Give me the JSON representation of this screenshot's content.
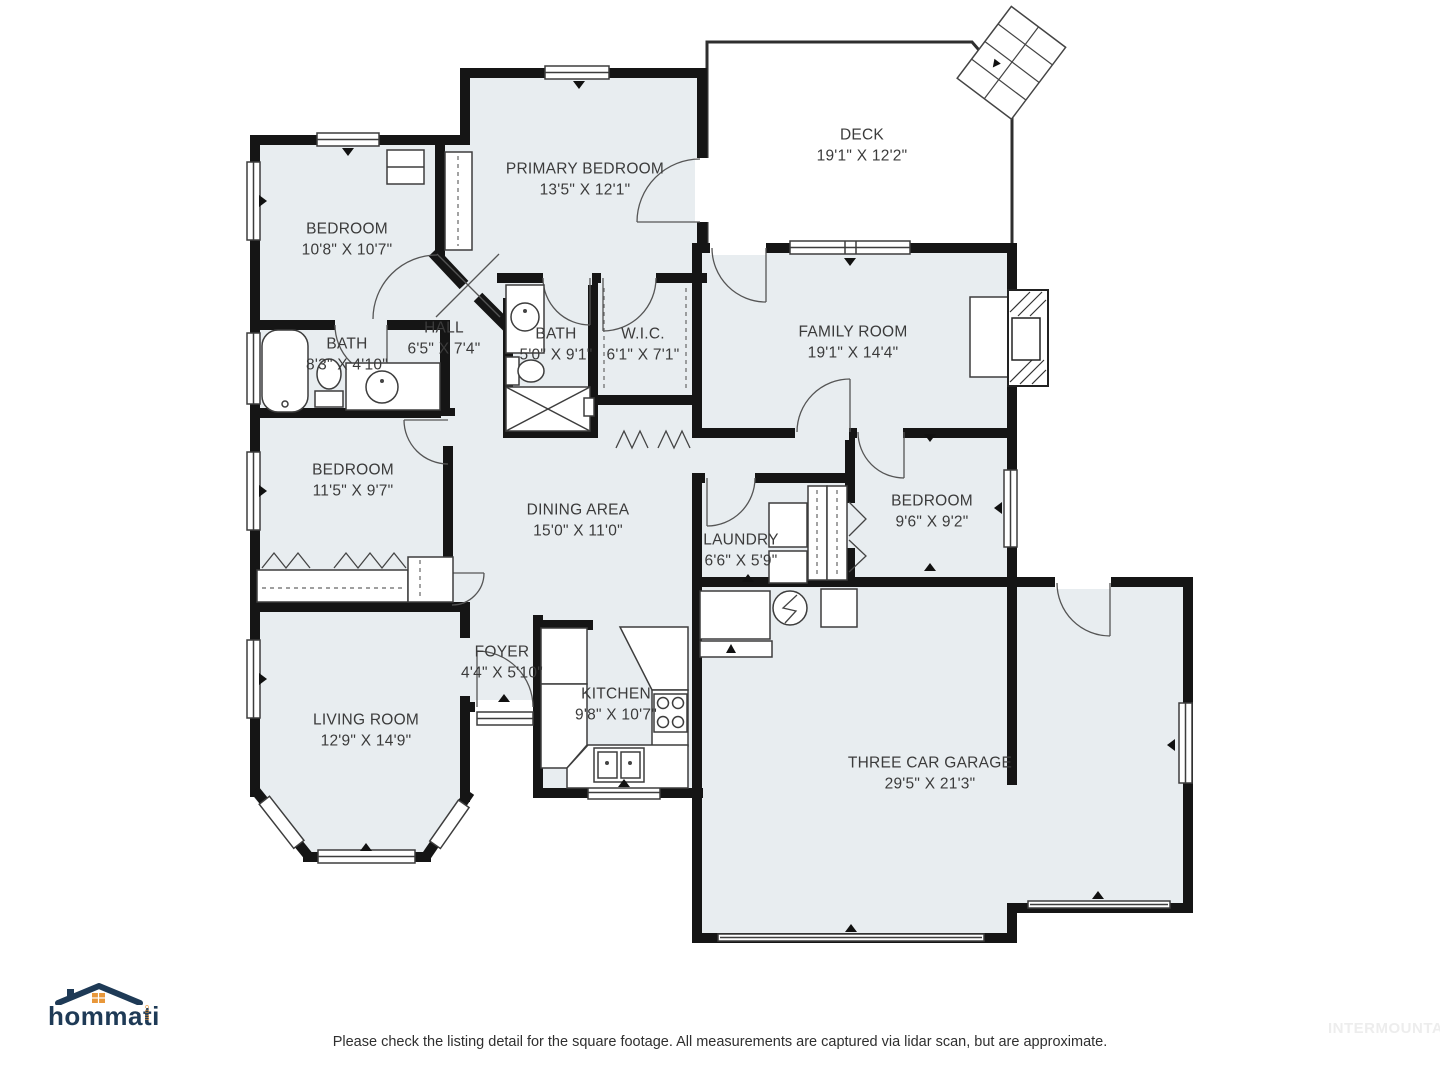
{
  "page": {
    "background": "#ffffff"
  },
  "palette": {
    "floor": "#e8edf0",
    "wall": "#151515",
    "line": "#3d3d3d",
    "label": "#3b3b3b",
    "logo_navy": "#1e3a56",
    "logo_orange": "#e8973a",
    "watermark_gray": "#ededed"
  },
  "rooms": [
    {
      "id": "deck",
      "name": "DECK",
      "dims": "19'1\" X 12'2\""
    },
    {
      "id": "primary-bedroom",
      "name": "PRIMARY BEDROOM",
      "dims": "13'5\" X 12'1\""
    },
    {
      "id": "bedroom-top-left",
      "name": "BEDROOM",
      "dims": "10'8\" X 10'7\""
    },
    {
      "id": "hall",
      "name": "HALL",
      "dims": "6'5\" X 7'4\""
    },
    {
      "id": "bath-primary",
      "name": "BATH",
      "dims": "5'0\" X 9'1\""
    },
    {
      "id": "wic",
      "name": "W.I.C.",
      "dims": "6'1\" X 7'1\""
    },
    {
      "id": "family-room",
      "name": "FAMILY ROOM",
      "dims": "19'1\" X 14'4\""
    },
    {
      "id": "bath-left",
      "name": "BATH",
      "dims": "8'3\" X 4'10\""
    },
    {
      "id": "bedroom-mid-left",
      "name": "BEDROOM",
      "dims": "11'5\" X 9'7\""
    },
    {
      "id": "dining-area",
      "name": "DINING AREA",
      "dims": "15'0\" X 11'0\""
    },
    {
      "id": "laundry",
      "name": "LAUNDRY",
      "dims": "6'6\" X 5'9\""
    },
    {
      "id": "bedroom-right",
      "name": "BEDROOM",
      "dims": "9'6\" X 9'2\""
    },
    {
      "id": "foyer",
      "name": "FOYER",
      "dims": "4'4\" X 5'10\""
    },
    {
      "id": "living-room",
      "name": "LIVING ROOM",
      "dims": "12'9\" X 14'9\""
    },
    {
      "id": "kitchen",
      "name": "KITCHEN",
      "dims": "9'8\" X 10'7\""
    },
    {
      "id": "garage",
      "name": "THREE CAR GARAGE",
      "dims": "29'5\" X 21'3\""
    }
  ],
  "logo": {
    "text": "hommati",
    "suffix": "com"
  },
  "footer": {
    "disclaimer": "Please check the listing detail for the square footage. All measurements are captured via lidar scan, but are approximate.",
    "watermark": "INTERMOUNTAIN"
  }
}
